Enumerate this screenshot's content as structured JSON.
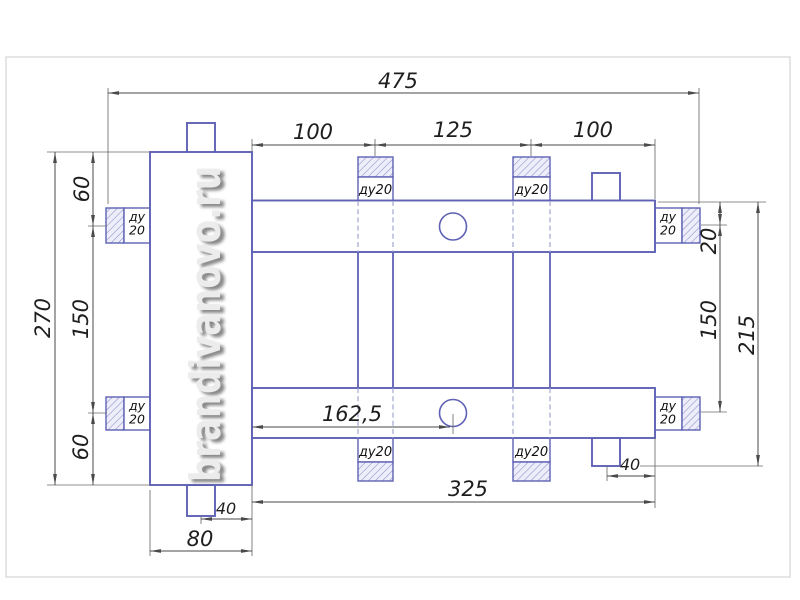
{
  "watermark": {
    "text": "brandivanovo.ru"
  },
  "ports": {
    "dn_single": "ду20",
    "dn_line1": "ду",
    "dn_line2": "20"
  },
  "dims": {
    "total_width": "475",
    "top_left_span": "100",
    "top_mid_span": "125",
    "top_right_span": "100",
    "left_upper": "60",
    "left_middle": "150",
    "left_lower": "60",
    "left_total": "270",
    "right_port_offset": "20",
    "right_port_span": "150",
    "right_total": "215",
    "circle_offset": "162,5",
    "bar_length": "325",
    "stub_offset_bottom": "40",
    "stub_offset_right": "40",
    "body_width": "80"
  },
  "colors": {
    "outline_blue": "#5e61b4",
    "dimension_gray": "#4a4a4a",
    "hatch_fill": "#edeef9",
    "frame_gray": "#c9cccf"
  }
}
